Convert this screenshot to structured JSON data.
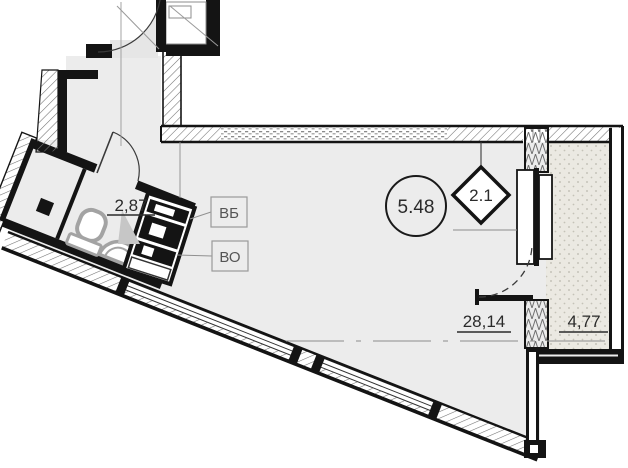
{
  "floor_plan": {
    "type": "apartment-studio-plan",
    "area_labels": {
      "bathroom": "2,87",
      "main_room": "28,14",
      "balcony": "4,77"
    },
    "markers": {
      "circle": "5.48",
      "diamond": "2.1"
    },
    "shaft_labels": {
      "vb": "ВБ",
      "vo": "ВО"
    },
    "colors": {
      "floor": "#ececec",
      "balcony_floor": "#ebe9e2",
      "wall": "#141414",
      "annotation": "#2b2b2b",
      "leader": "#909090",
      "fixture": "#a3a3a3",
      "swing_area": "#e6e6e6"
    }
  }
}
